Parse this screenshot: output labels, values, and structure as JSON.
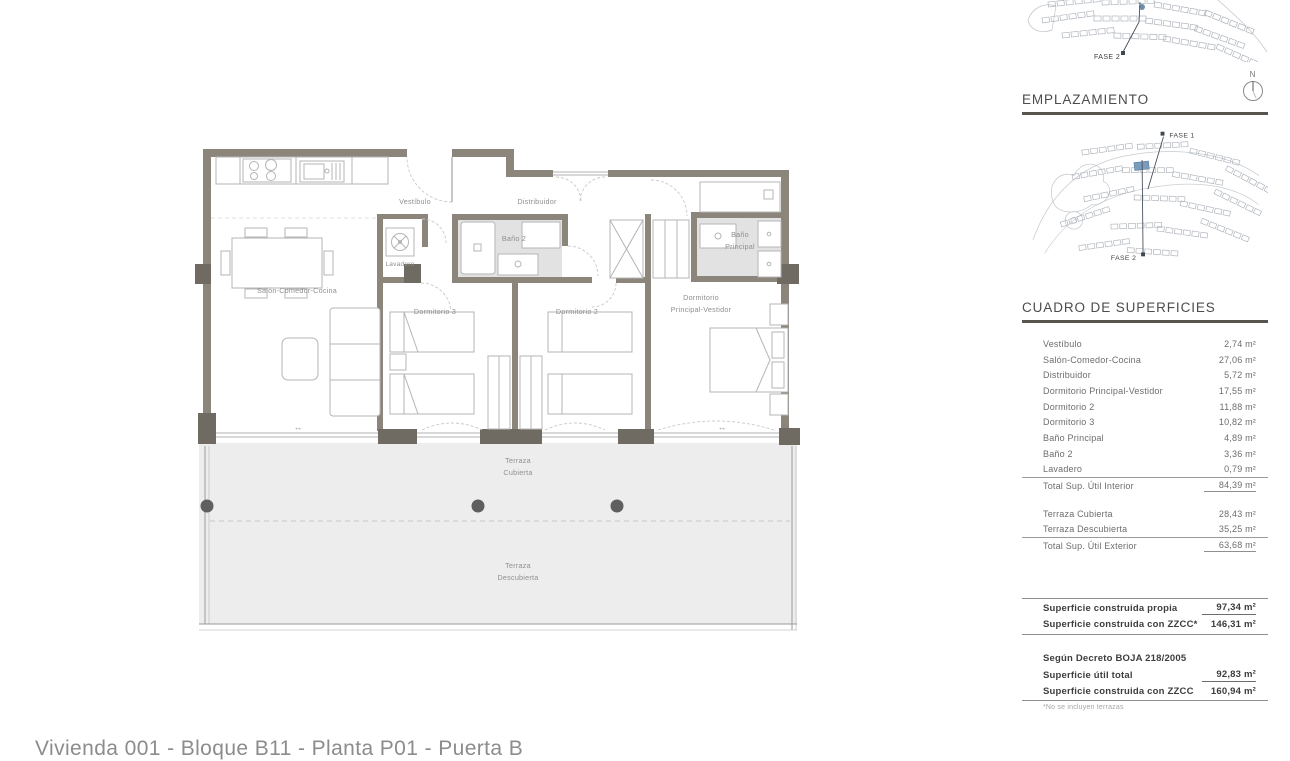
{
  "footer": {
    "title": "Vivienda 001 - Bloque B11 - Planta P01 - Puerta B"
  },
  "plan": {
    "rooms": {
      "vestibulo": "Vestíbulo",
      "distribuidor": "Distribuidor",
      "lavadero": "Lavadero",
      "bano2": "Baño 2",
      "salon": "Salón-Comedor-Cocina",
      "dorm3": "Dormitorio 3",
      "dorm2": "Dormitorio 2",
      "dorm_ppal_l1": "Dormitorio",
      "dorm_ppal_l2": "Principal-Vestidor",
      "bano_ppal_l1": "Baño",
      "bano_ppal_l2": "Principal",
      "terraza_cub_l1": "Terraza",
      "terraza_cub_l2": "Cubierta",
      "terraza_desc_l1": "Terraza",
      "terraza_desc_l2": "Descubierta"
    },
    "glyphs": {
      "slide_arrow": "↔"
    }
  },
  "sidebar": {
    "emplazamiento_title": "EMPLAZAMIENTO",
    "compass_n": "N",
    "site_plan_top": {
      "fase2": "FASE 2"
    },
    "site_plan_main": {
      "fase1": "FASE 1",
      "fase2": "FASE 2"
    },
    "surfaces": {
      "title": "CUADRO DE SUPERFICIES",
      "interior_rows": [
        {
          "label": "Vestíbulo",
          "value": "2,74 m²"
        },
        {
          "label": "Salón-Comedor-Cocina",
          "value": "27,06 m²"
        },
        {
          "label": "Distribuidor",
          "value": "5,72 m²"
        },
        {
          "label": "Dormitorio Principal-Vestidor",
          "value": "17,55 m²"
        },
        {
          "label": "Dormitorio 2",
          "value": "11,88 m²"
        },
        {
          "label": "Dormitorio 3",
          "value": "10,82 m²"
        },
        {
          "label": "Baño Principal",
          "value": "4,89 m²"
        },
        {
          "label": "Baño 2",
          "value": "3,36 m²"
        },
        {
          "label": "Lavadero",
          "value": "0,79 m²"
        }
      ],
      "interior_total": {
        "label": "Total Sup. Útil Interior",
        "value": "84,39 m²"
      },
      "exterior_rows": [
        {
          "label": "Terraza Cubierta",
          "value": "28,43 m²"
        },
        {
          "label": "Terraza Descubierta",
          "value": "35,25 m²"
        }
      ],
      "exterior_total": {
        "label": "Total Sup. Útil Exterior",
        "value": "63,68 m²"
      },
      "construida_rows": [
        {
          "label": "Superficie construida propia",
          "value": "97,34 m²"
        },
        {
          "label": "Superficie construida con ZZCC*",
          "value": "146,31 m²"
        }
      ],
      "decreto_heading": "Según Decreto BOJA 218/2005",
      "decreto_rows": [
        {
          "label": "Superficie útil total",
          "value": "92,83 m²"
        },
        {
          "label": "Superficie construida con ZZCC",
          "value": "160,94 m²"
        }
      ],
      "footnote": "*No se incluyen terrazas"
    }
  },
  "colors": {
    "wall": "#8b857b",
    "pier": "#6f6a62",
    "terrace_fill": "#ededed",
    "bath_fill": "#e2e2e2",
    "furniture_stroke": "#b5b5b5",
    "highlight_blue": "#7c9cbe",
    "heading_underline": "#59554e"
  }
}
